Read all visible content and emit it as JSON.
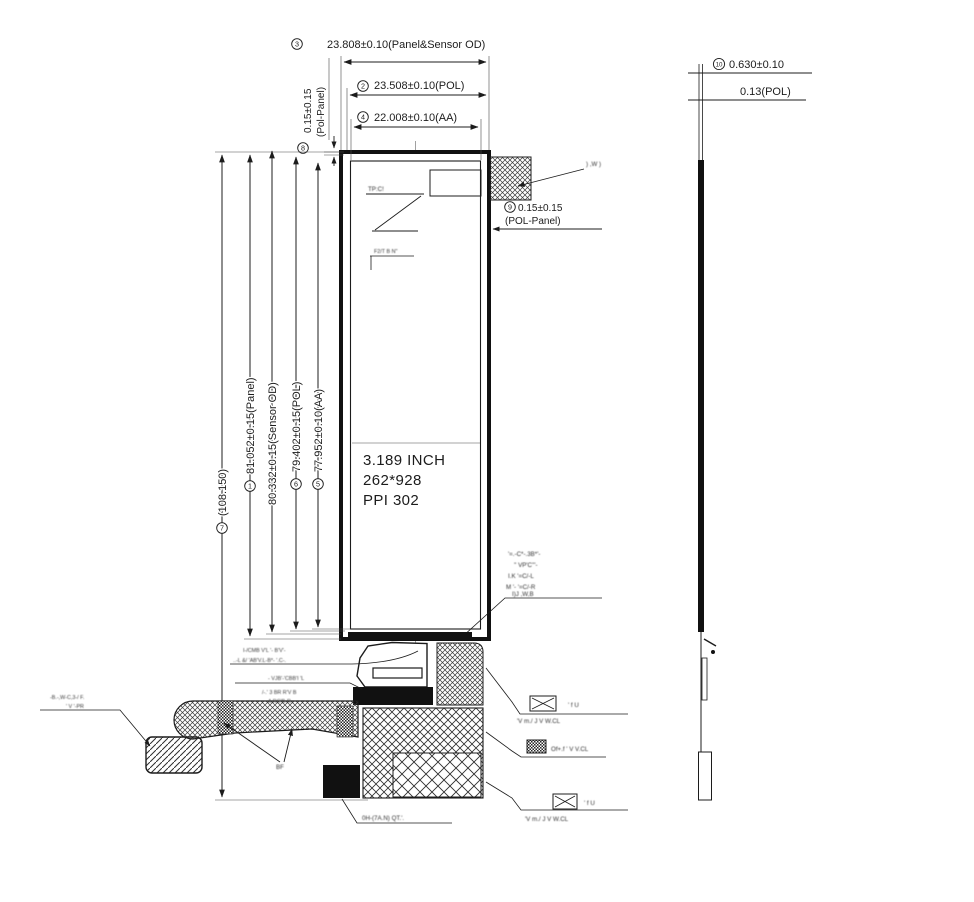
{
  "front_view": {
    "spec": {
      "line1": "3.189 INCH",
      "line2": "262*928",
      "line3": "PPI 302"
    },
    "dims": {
      "panel_sensor_od_w": {
        "num": "3",
        "label": "23.808±0.10(Panel&Sensor OD)"
      },
      "pol_w": {
        "num": "2",
        "label": "23.508±0.10(POL)"
      },
      "aa_w": {
        "num": "4",
        "label": "22.008±0.10(AA)"
      },
      "pol_panel_top": {
        "num": "8",
        "label": "0.15±0.15",
        "label2": "(Pol-Panel)"
      },
      "overall_h": {
        "num": "7",
        "label": "(108.150)"
      },
      "panel_h": {
        "num": "1",
        "label": "81.052±0.15(Panel)"
      },
      "sensor_od_h": {
        "label": "80.332±0.15(Sensor OD)"
      },
      "pol_h": {
        "num": "6",
        "label": "79.402±0.15(POL)"
      },
      "aa_h": {
        "num": "5",
        "label": "77.952±0.10(AA)"
      },
      "pol_panel_side": {
        "num": "9",
        "label": "0.15±0.15",
        "label2": "(POL-Panel)"
      }
    },
    "tp_label": "TP:C!",
    "fpc_label": "BF"
  },
  "side_view": {
    "thickness": {
      "num": "10",
      "label": "0.630±0.10"
    },
    "pol_thickness_label": "0.13(POL)"
  },
  "notes": {
    "adhesive_note": ") ,W )",
    "corner_note": {
      "l1": "'=.-C*-.3B*'-",
      "l2": "'' VP'C'''-",
      "l3": "I.K '=C/-L",
      "l4": "M '- '=C/-R",
      "l5": "I)J ,W,B"
    },
    "connector_note_a": {
      "l1": "I-/CMB V'L '-   B'V'-",
      "l2": "..-L &/ 'AB'V.L-B*- '.C-."
    },
    "connector_note_b": {
      "l1": "- VJB'-'CBB'I 'L",
      "l2": "/-.' 3  BR  R'V B",
      "l3": "A RC'B-R.."
    },
    "fpc_note": {
      "l1": "-B.-,W-C,3-/ F.",
      "l2": "' V  '-PR"
    },
    "inner_note": "F2/T B  N''",
    "bottom_note": "0H-(7A.N) QT.'."
  },
  "legend": {
    "item1": {
      "l1": "' f U",
      "l2": "'V  m./ J V W.CL"
    },
    "item2": {
      "l1": "Of+.f ' V V.CL"
    },
    "item3": {
      "l1": "' f U",
      "l2": "'V  m./ J V W.CL"
    }
  },
  "colors": {
    "ink": "#1c1c1c",
    "background": "#ffffff"
  }
}
